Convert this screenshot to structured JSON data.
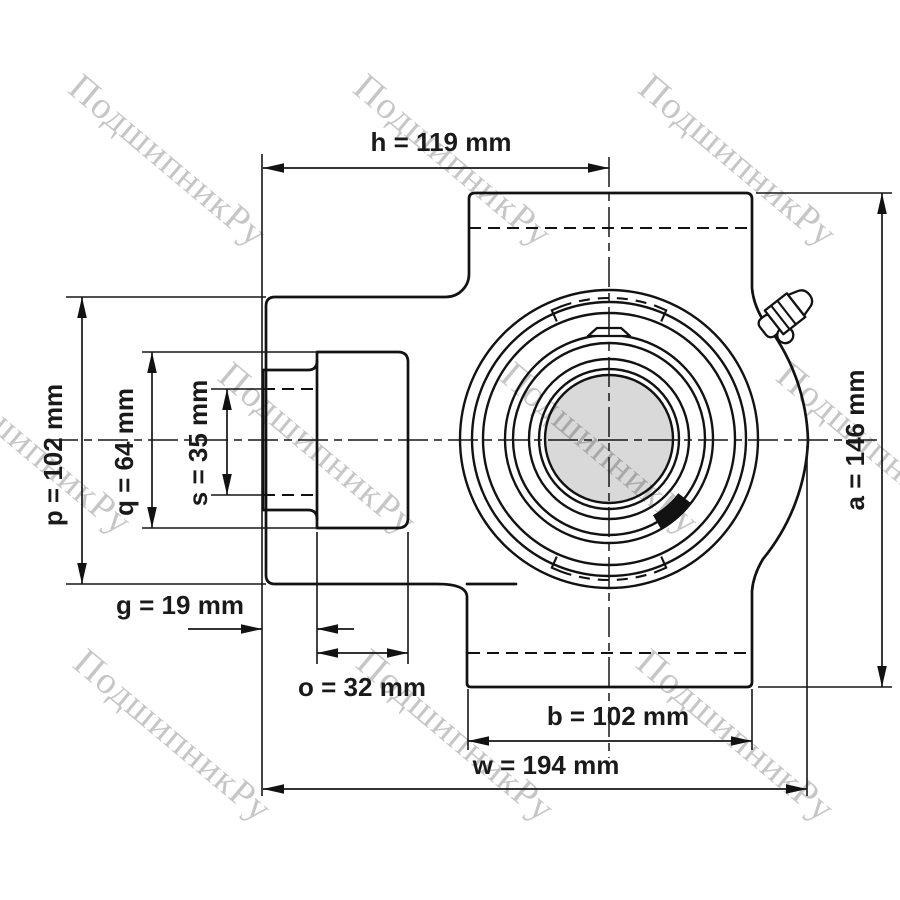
{
  "drawing": {
    "type": "bearing-unit-technical-drawing",
    "background": "#ffffff",
    "line_color": "#121212",
    "shaft_fill": "#d9d9d9",
    "watermark_color": "#c6c6c6"
  },
  "watermark": {
    "text": "ПодшипникРу"
  },
  "dimensions": {
    "h": {
      "label": "h = 119 mm",
      "name": "h",
      "value": 119,
      "unit": "mm"
    },
    "p": {
      "label": "p = 102 mm",
      "name": "p",
      "value": 102,
      "unit": "mm"
    },
    "q": {
      "label": "q = 64 mm",
      "name": "q",
      "value": 64,
      "unit": "mm"
    },
    "s": {
      "label": "s = 35 mm",
      "name": "s",
      "value": 35,
      "unit": "mm"
    },
    "g": {
      "label": "g = 19 mm",
      "name": "g",
      "value": 19,
      "unit": "mm"
    },
    "o": {
      "label": "o = 32 mm",
      "name": "o",
      "value": 32,
      "unit": "mm"
    },
    "b": {
      "label": "b = 102 mm",
      "name": "b",
      "value": 102,
      "unit": "mm"
    },
    "w": {
      "label": "w = 194 mm",
      "name": "w",
      "value": 194,
      "unit": "mm"
    },
    "a": {
      "label": "a = 146 mm",
      "name": "a",
      "value": 146,
      "unit": "mm"
    }
  }
}
